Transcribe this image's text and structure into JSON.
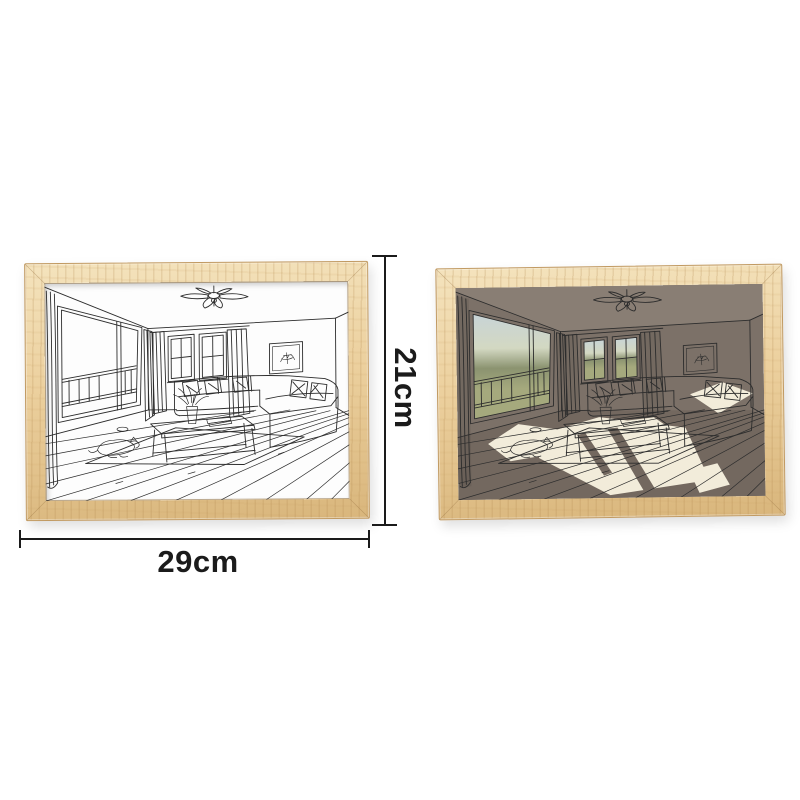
{
  "dimensions": {
    "height_label": "21cm",
    "width_label": "29cm"
  },
  "colors": {
    "page_bg": "#ffffff",
    "line": "#2d2d2d",
    "dim": "#1b1b1b",
    "wood_light": "#f4e3bd",
    "wood_mid": "#ecd09e",
    "wood_dark": "#d9b67c",
    "wood_edge": "#c19a62",
    "picture_bg": "#fdfdfd",
    "lit_wall": "#7c7168",
    "lit_ceiling": "#897e74",
    "lit_floor": "#73685f",
    "sunlight": "#f2ecda",
    "sky": "#c8d4d7",
    "haze": "#d3d8c2",
    "foliage": "#8b9370",
    "grass": "#a5a97d"
  }
}
